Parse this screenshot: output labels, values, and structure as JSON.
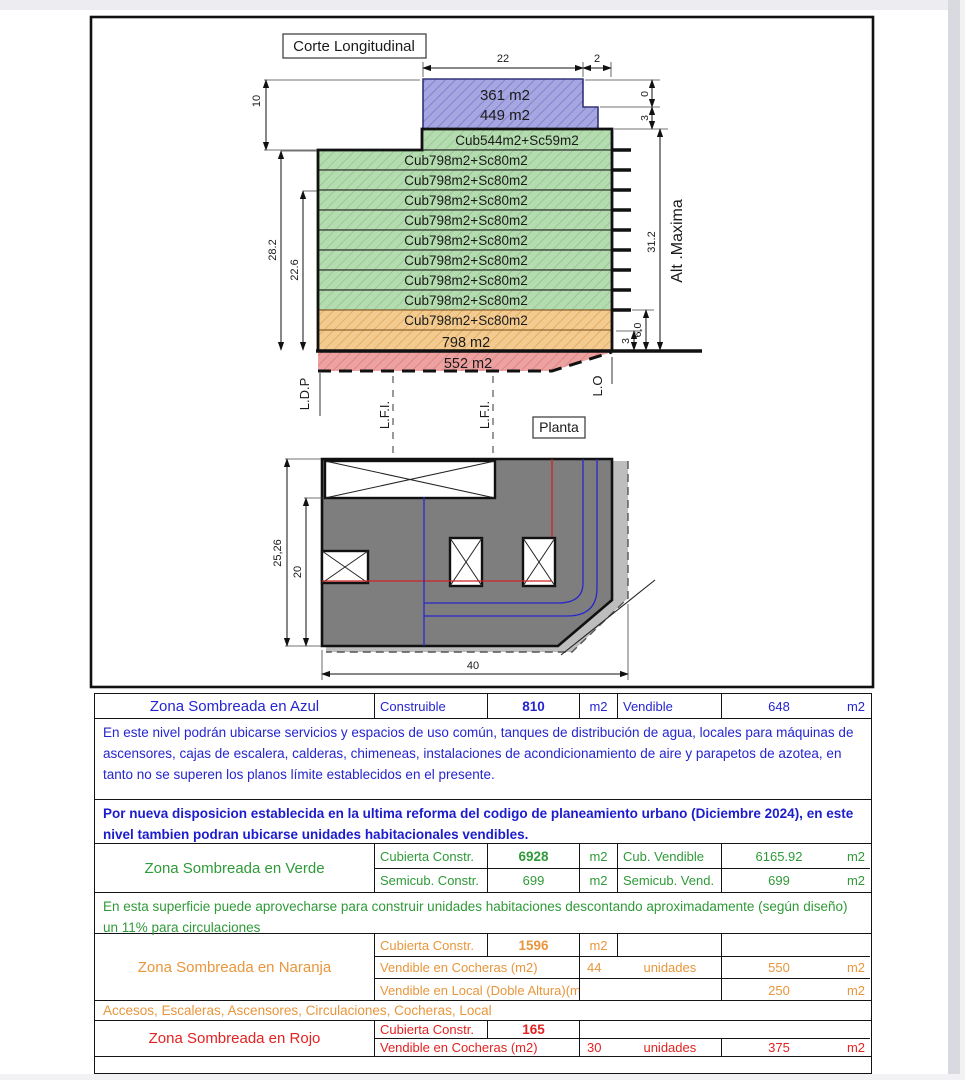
{
  "drawing": {
    "section_title": "Corte Longitudinal",
    "plan_title": "Planta",
    "blue_area_line1": "361 m2",
    "blue_area_line2": "449 m2",
    "roof_floor_label": "Cub544m2+Sc59m2",
    "typical_floor_labels": [
      "Cub798m2+Sc80m2",
      "Cub798m2+Sc80m2",
      "Cub798m2+Sc80m2",
      "Cub798m2+Sc80m2",
      "Cub798m2+Sc80m2",
      "Cub798m2+Sc80m2",
      "Cub798m2+Sc80m2",
      "Cub798m2+Sc80m2"
    ],
    "orange_floor_label": "Cub798m2+Sc80m2",
    "ground_floor_label": "798 m2",
    "basement_label": "552 m2",
    "dims": {
      "top_width": "22",
      "top_step": "2",
      "upper_height": "10",
      "left_total": "28.2",
      "left_partial": "22.6",
      "right_zero": "0",
      "right_step": "3",
      "total_height": "31.2",
      "alt_maxima": "Alt .Maxima",
      "base_height": "6,0",
      "base_step": "3",
      "plan_height": "25,26",
      "plan_partial_height": "20",
      "plan_width": "40"
    },
    "ref_lines": {
      "ldp": "L.D.P",
      "lfi_1": "L.F.I.",
      "lfi_2": "L.F.I.",
      "lo": "L.O"
    }
  },
  "zones": {
    "blue": {
      "name": "Zona Sombreada en Azul",
      "row": {
        "label": "Construible",
        "value": "810",
        "unit": "m2",
        "label2": "Vendible",
        "value2": "648",
        "unit2": "m2"
      },
      "note": "En este nivel podrán ubicarse servicios y espacios de uso común, tanques de distribución de agua, locales para máquinas de ascensores, cajas de escalera, calderas, chimeneas, instalaciones de acondicionamiento de aire y parapetos de azotea, en tanto no se superen los planos límite establecidos en el presente.",
      "note_bold": "Por nueva disposicion establecida en la ultima reforma del codigo de planeamiento urbano (Diciembre 2024), en este nivel tambien podran ubicarse unidades habitacionales vendibles."
    },
    "green": {
      "name": "Zona Sombreada en Verde",
      "rows": [
        {
          "label": "Cubierta Constr.",
          "value": "6928",
          "unit": "m2",
          "label2": "Cub. Vendible",
          "value2": "6165.92",
          "unit2": "m2"
        },
        {
          "label": "Semicub. Constr.",
          "value": "699",
          "unit": "m2",
          "label2": "Semicub. Vend.",
          "value2": "699",
          "unit2": "m2"
        }
      ],
      "note": "En esta superficie puede aprovecharse para construir unidades habitaciones descontando aproximadamente (según diseño) un 11% para circulaciones"
    },
    "orange": {
      "name": "Zona Sombreada en Naranja",
      "row1": {
        "label": "Cubierta Constr.",
        "value": "1596",
        "unit": "m2"
      },
      "row2": {
        "label": "Vendible en Cocheras (m2)",
        "qty": "44",
        "qty_unit": "unidades",
        "value": "550",
        "unit": "m2"
      },
      "row3": {
        "label": "Vendible en Local (Doble Altura)(m2",
        "value": "250",
        "unit": "m2"
      },
      "note": "Accesos, Escaleras, Ascensores, Circulaciones, Cocheras, Local"
    },
    "red": {
      "name": "Zona Sombreada en Rojo",
      "row1": {
        "label": "Cubierta Constr.",
        "value": "165"
      },
      "row2": {
        "label": "Vendible en Cocheras (m2)",
        "qty": "30",
        "qty_unit": "unidades",
        "value": "375",
        "unit": "m2"
      }
    }
  },
  "colors": {
    "blue_fill": "#a6a6e0",
    "green_fill": "#b5dcb0",
    "orange_fill": "#f3cb90",
    "red_fill": "#eda2a2",
    "plan_gray": "#7e7e7e",
    "blue_text": "#2525cf",
    "green_text": "#2f9a38",
    "orange_text": "#e8963c",
    "red_text": "#e32222"
  }
}
